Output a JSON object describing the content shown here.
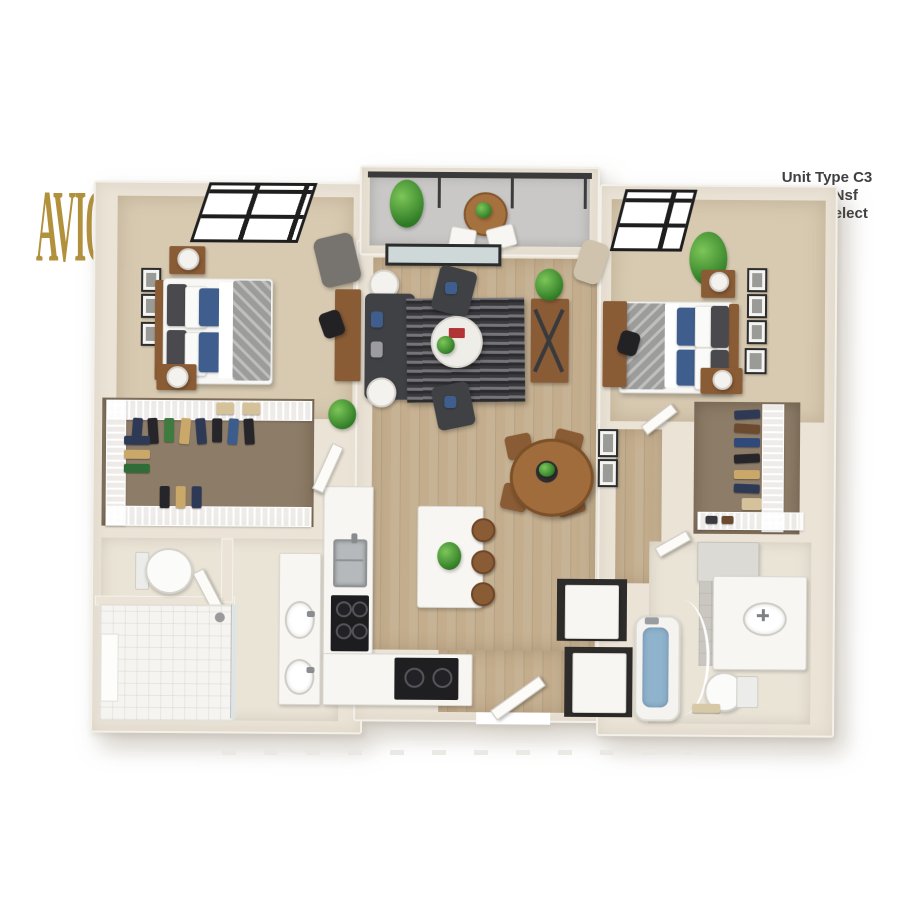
{
  "branding": {
    "logo_text": "AVION",
    "logo_color": "#b2913d"
  },
  "unit_info": {
    "line1": "Unit Type C3",
    "line2": "1223 Nsf",
    "line3": "2x2 / Select",
    "text_color": "#3f4042"
  },
  "palette": {
    "logo_gold": "#b2913d",
    "info_text": "#3f4042",
    "wall": "#eae3d6",
    "carpet": "#d8cab1",
    "hardwood": "#c3ad8d",
    "closet_floor": "#8d7c67",
    "bath_floor": "#eae4d7",
    "balcony_floor": "#c9c8c6",
    "laundry_floor": "#2e2c2a",
    "dark_furniture": "#3f4144",
    "wood_furniture": "#8a5c36",
    "accent_pillow_blue": "#3f5e8e",
    "plant_green": "#2e7a24",
    "tub_water": "#8fb3cc",
    "appliance_black": "#1d1d1f"
  }
}
